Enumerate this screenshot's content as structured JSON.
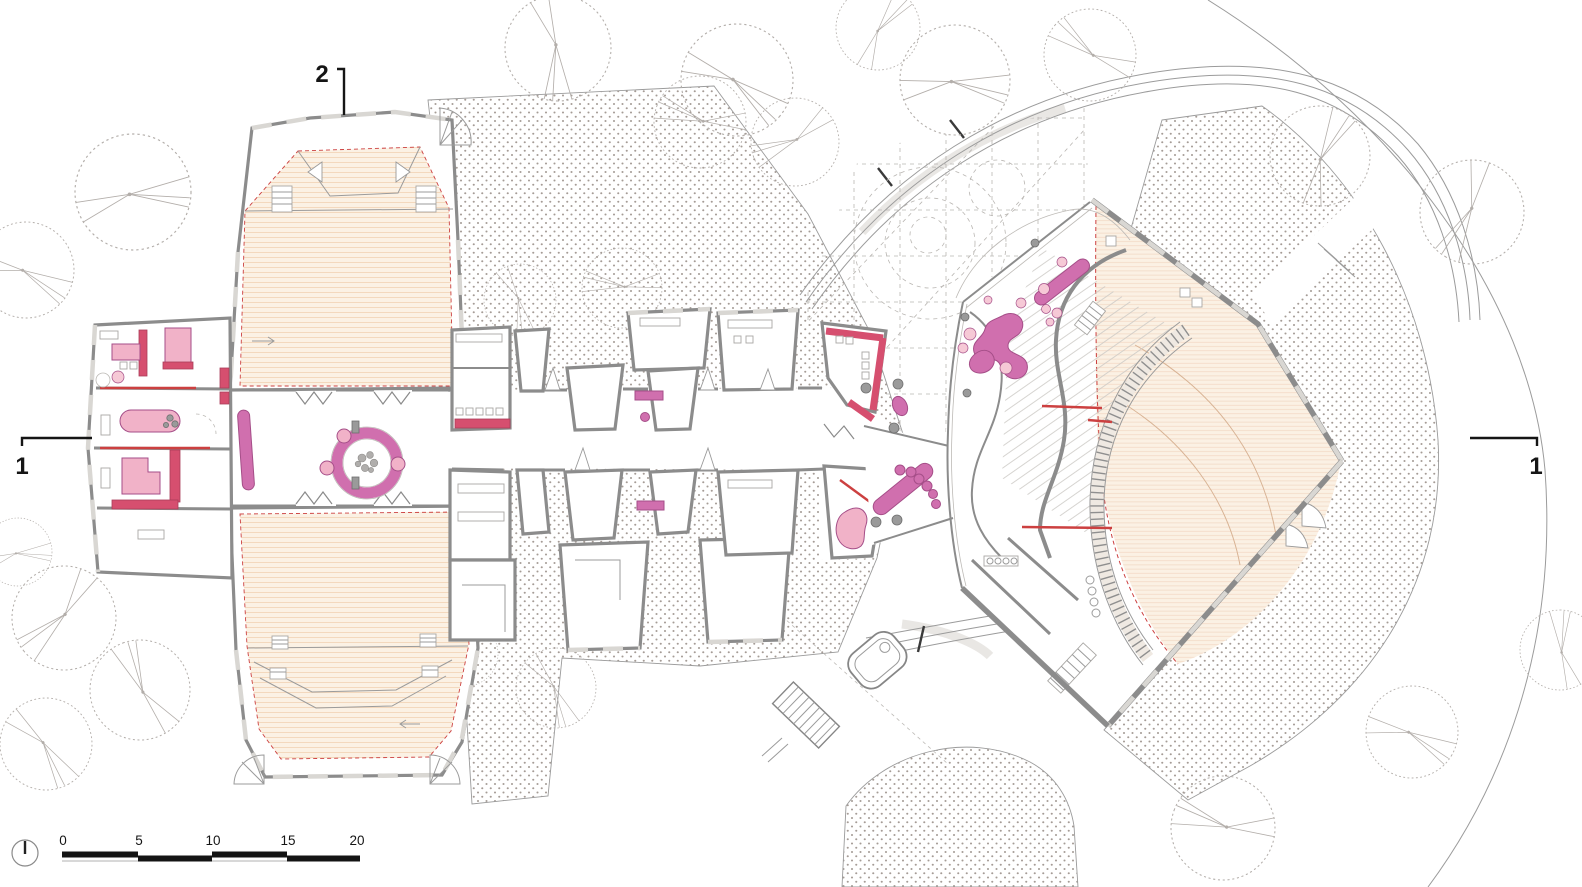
{
  "section_markers": {
    "top": {
      "label": "2"
    },
    "left": {
      "label": "1"
    },
    "right": {
      "label": "1"
    }
  },
  "scale_bar": {
    "labels": [
      "0",
      "5",
      "10",
      "15",
      "20"
    ]
  },
  "icons": {
    "north_arrow": "north-arrow-circle"
  },
  "colors": {
    "wall": "#8c8c8c",
    "win": "#d9d7d3",
    "dotc": "#a59c96",
    "cream": "#fbf1e4",
    "creamline": "#f2d2b4",
    "red": "#cc4040",
    "crimson": "#d64f6f",
    "crimsondark": "#aa3c58",
    "pink": "#d06fae",
    "pinkdark": "#a54e88",
    "pinklight": "#f1b2c8",
    "pinkpale": "#f6c9d6",
    "tree": "#b3aeaa",
    "grid": "#b9b6b2",
    "line": "#9b9b9b"
  }
}
